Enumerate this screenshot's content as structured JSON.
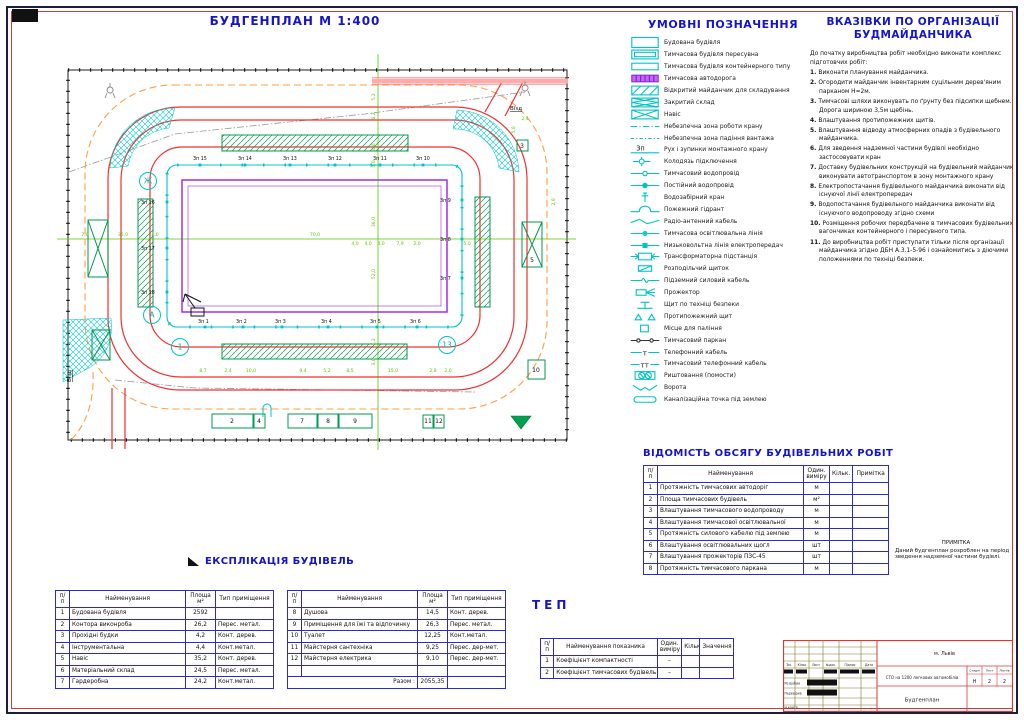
{
  "title": "БУДГЕНПЛАН М 1:400",
  "legend": {
    "title": "УМОВНІ ПОЗНАЧЕННЯ",
    "items": [
      {
        "symbol": "building-outline-icon",
        "label": "Будована будівля"
      },
      {
        "symbol": "mobile-building-icon",
        "label": "Тимчасова будівля пересувна"
      },
      {
        "symbol": "container-building-icon",
        "label": "Тимчасова будівля контейнерного типу"
      },
      {
        "symbol": "temp-road-icon",
        "label": "Тимчасова автодорога"
      },
      {
        "symbol": "open-storage-icon",
        "label": "Відкритий майданчик для складування"
      },
      {
        "symbol": "closed-storage-icon",
        "label": "Закритий склад"
      },
      {
        "symbol": "shed-icon",
        "label": "Навіс"
      },
      {
        "symbol": "danger-crane-zone-icon",
        "label": "Небезпечна зона роботи крану"
      },
      {
        "symbol": "danger-load-zone-icon",
        "label": "Небезпечна зона падіння вантажа"
      },
      {
        "symbol": "crane-stops-icon",
        "label": "Рух і зупинки монтажного крану"
      },
      {
        "symbol": "connection-well-icon",
        "label": "Колодязь підключення"
      },
      {
        "symbol": "temp-water-line-icon",
        "label": "Тимчасовий водопровід"
      },
      {
        "symbol": "perm-water-line-icon",
        "label": "Постійний водопровід"
      },
      {
        "symbol": "water-tap-icon",
        "label": "Водозабірний кран"
      },
      {
        "symbol": "fire-hydrant-icon",
        "label": "Пожежний гідрант"
      },
      {
        "symbol": "radio-cable-icon",
        "label": "Радіо-антенний кабель"
      },
      {
        "symbol": "temp-light-line-icon",
        "label": "Тимчасова освітлювальна лінія"
      },
      {
        "symbol": "lv-power-line-icon",
        "label": "Низьковольтна лінія електропередач"
      },
      {
        "symbol": "transformer-icon",
        "label": "Трансформаторна підстанція"
      },
      {
        "symbol": "switchboard-icon",
        "label": "Розподільчий щиток"
      },
      {
        "symbol": "underground-cable-icon",
        "label": "Підземний силовий кабель"
      },
      {
        "symbol": "floodlight-icon",
        "label": "Прожектор"
      },
      {
        "symbol": "safety-board-icon",
        "label": "Щит по техніці безпеки"
      },
      {
        "symbol": "fire-board-icon",
        "label": "Протипожежний щит"
      },
      {
        "symbol": "smoking-area-icon",
        "label": "Місце для паління"
      },
      {
        "symbol": "temp-fence-icon",
        "label": "Тимчасовий паркан"
      },
      {
        "symbol": "phone-cable-icon",
        "label": "Телефонний кабель"
      },
      {
        "symbol": "temp-phone-cable-icon",
        "label": "Тимчасовий телефонний кабель"
      },
      {
        "symbol": "scaffold-icon",
        "label": "Риштовання (помости)"
      },
      {
        "symbol": "gate-icon",
        "label": "Ворота"
      },
      {
        "symbol": "sewer-point-icon",
        "label": "Каналізаційна точка під землею"
      }
    ]
  },
  "instructions": {
    "title_line1": "ВКАЗІВКИ ПО ОРГАНІЗАЦІЇ",
    "title_line2": "БУДМАЙДАНЧИКА",
    "intro": "До початку виробництва робіт необхідно виконати комплекс підготовчих робіт:",
    "items": [
      "Виконати планування майданчика.",
      "Огородити майданчик інвентарним суцільним дерев'яним парканом Н=2м.",
      "Тимчасові шляхи виконувать по ґрунту без підсипки щебнем. Дорога шириною 3,5м щебінь.",
      "Влаштування протипожежних щитів.",
      "Влаштування відводу атмосферних опадів з будівельного майданчика.",
      "Для зведення надземної частини будівлі необхідно застосовувати кран",
      "Доставку будівельних конструкцій на будівельний майданчик виконувати автотранспортом в зону монтажного крану",
      "Електропостачання будівельного майданчика виконати від існуючої лінії електропередач",
      "Водопостачання будівельного майданчика виконати від існуючого водопроводу згідно схеми",
      "Розміщення робочих передбачене в тимчасових будівельних вагончиках контейнерного і пересувного типа.",
      "До виробництва робіт приступати тільки після організації майданчика згідно ДБН А.3.1-5-96 і ознайомитись з діючими положеннями по техніці безпеки."
    ]
  },
  "works_table": {
    "title": "ВІДОМІСТЬ ОБСЯГУ  БУДІВЕЛЬНИХ РОБІТ",
    "headers": [
      "п/п",
      "Найменування",
      "Один. виміру",
      "Кільк.",
      "Примітка"
    ],
    "rows": [
      [
        "1",
        "Протяжність тимчасових автодоріг",
        "м",
        "",
        ""
      ],
      [
        "2",
        "Площа тимчасових будівель",
        "м²",
        "",
        ""
      ],
      [
        "3",
        "Влаштування тимчасового водопроводу",
        "м",
        "",
        ""
      ],
      [
        "4",
        "Влаштування тимчасової освітлювальної",
        "м",
        "",
        ""
      ],
      [
        "5",
        "Протяжність силового кабелю під землею",
        "м",
        "",
        ""
      ],
      [
        "6",
        "Влаштування освітлювальних щогл",
        "шт",
        "",
        ""
      ],
      [
        "7",
        "Влаштування прожекторів ПЗС-45",
        "шт",
        "",
        ""
      ],
      [
        "8",
        "Протяжність тимчасового паркана",
        "м",
        "",
        ""
      ]
    ]
  },
  "note": {
    "title": "ПРИМІТКА",
    "text": "Даний будгенплан розроблен на період зведення надземної частини будівлі."
  },
  "explication": {
    "title": "ЕКСПЛІКАЦІЯ БУДІВЕЛЬ",
    "headers": [
      "п/п",
      "Найменування",
      "Площа м²",
      "Тип приміщення"
    ],
    "left_rows": [
      [
        "1",
        "Будована будівля",
        "2592",
        ""
      ],
      [
        "2",
        "Контора виконроба",
        "26,2",
        "Перес. метал."
      ],
      [
        "3",
        "Прохідні будки",
        "4,2",
        "Конт. дерев."
      ],
      [
        "4",
        "Інструментальна",
        "4,4",
        "Конт.метал."
      ],
      [
        "5",
        "Навіс",
        "35,2",
        "Конт. дерев."
      ],
      [
        "6",
        "Матеріальний склад",
        "24,5",
        "Перес. метал."
      ],
      [
        "7",
        "Гардеробна",
        "24,2",
        "Конт.метал."
      ]
    ],
    "right_rows": [
      [
        "8",
        "Душова",
        "14,5",
        "Конт. дерев."
      ],
      [
        "9",
        "Приміщення для їжі та відпочинку",
        "26,3",
        "Перес. метал."
      ],
      [
        "10",
        "Туалет",
        "12,25",
        "Конт.метал."
      ],
      [
        "11",
        "Майстерня сантехніка",
        "9,25",
        "Перес. дер-мет."
      ],
      [
        "12",
        "Майстерня електрика",
        "9,10",
        "Перес. дер-мет."
      ],
      [
        "",
        "",
        "",
        ""
      ]
    ],
    "total_label": "Разом :",
    "total_value": "2055,35"
  },
  "tep": {
    "title": "ТЕП",
    "headers": [
      "п/п",
      "Найменування показника",
      "Один. виміру",
      "Кільк",
      "Значення"
    ],
    "rows": [
      [
        "1",
        "Коефіцієнт компактності",
        "–",
        "",
        ""
      ],
      [
        "2",
        "Коефіцієнт тимчасових будівель",
        "–",
        "",
        ""
      ]
    ]
  },
  "stamp": {
    "city": "м. Львів",
    "project": "СТО на 1200 легкових автомобілів",
    "stage_label": "Стадія",
    "sheet_label": "Лист",
    "sheets_label": "Листів",
    "stage": "Н",
    "sheet": "2",
    "sheets": "2",
    "drawing_title": "Будгенплан",
    "cols": [
      "Зм.",
      "Кільк",
      "Лист",
      "№док.",
      "Підпис",
      "Дата"
    ],
    "roles": [
      "Розробив",
      "Перевірив",
      "Н.контр."
    ]
  },
  "plan": {
    "axes": [
      {
        "t": "Ж",
        "x": 93,
        "y": 129
      },
      {
        "t": "А",
        "x": 97,
        "y": 263
      },
      {
        "t": "1",
        "x": 125,
        "y": 295
      },
      {
        "t": "13",
        "x": 392,
        "y": 293
      }
    ],
    "crane_stops": [
      {
        "t": "Зп 1",
        "x": 143,
        "y": 271,
        "sx": 150,
        "sy": 275
      },
      {
        "t": "Зп 2",
        "x": 181,
        "y": 271,
        "sx": 188,
        "sy": 275
      },
      {
        "t": "Зп 3",
        "x": 220,
        "y": 271,
        "sx": 227,
        "sy": 275
      },
      {
        "t": "Зп 4",
        "x": 266,
        "y": 271,
        "sx": 273,
        "sy": 275
      },
      {
        "t": "Зп 5",
        "x": 315,
        "y": 271,
        "sx": 322,
        "sy": 275
      },
      {
        "t": "Зп 6",
        "x": 355,
        "y": 271,
        "sx": 362,
        "sy": 275
      },
      {
        "t": "Зп 7",
        "x": 385,
        "y": 228,
        "sx": 407,
        "sy": 226
      },
      {
        "t": "Зп 8",
        "x": 385,
        "y": 189,
        "sx": 407,
        "sy": 187
      },
      {
        "t": "Зп 9",
        "x": 385,
        "y": 150,
        "sx": 407,
        "sy": 148
      },
      {
        "t": "Зп 10",
        "x": 361,
        "y": 108,
        "sx": 368,
        "sy": 113
      },
      {
        "t": "Зп 11",
        "x": 318,
        "y": 108,
        "sx": 325,
        "sy": 113
      },
      {
        "t": "Зп 12",
        "x": 273,
        "y": 108,
        "sx": 280,
        "sy": 113
      },
      {
        "t": "Зп 13",
        "x": 228,
        "y": 108,
        "sx": 235,
        "sy": 113
      },
      {
        "t": "Зп 14",
        "x": 183,
        "y": 108,
        "sx": 190,
        "sy": 113
      },
      {
        "t": "Зп 15",
        "x": 138,
        "y": 108,
        "sx": 145,
        "sy": 113
      },
      {
        "t": "Зп 16",
        "x": 86,
        "y": 152,
        "sx": 112,
        "sy": 150
      },
      {
        "t": "Зп 17",
        "x": 86,
        "y": 198,
        "sx": 112,
        "sy": 196
      },
      {
        "t": "Зп 18",
        "x": 86,
        "y": 242,
        "sx": 112,
        "sy": 240
      }
    ],
    "building_numbers": [
      {
        "t": "2",
        "x": 177,
        "y": 371
      },
      {
        "t": "4",
        "x": 204,
        "y": 371
      },
      {
        "t": "7",
        "x": 247,
        "y": 371
      },
      {
        "t": "8",
        "x": 273,
        "y": 371
      },
      {
        "t": "9",
        "x": 300,
        "y": 371
      },
      {
        "t": "11",
        "x": 373,
        "y": 371
      },
      {
        "t": "12",
        "x": 384,
        "y": 371
      },
      {
        "t": "3",
        "x": 467,
        "y": 96
      },
      {
        "t": "5",
        "x": 477,
        "y": 210
      },
      {
        "t": "10",
        "x": 481,
        "y": 320
      }
    ],
    "dimensions": [
      {
        "t": "8,7",
        "x": 148,
        "y": 320
      },
      {
        "t": "2,4",
        "x": 173,
        "y": 320
      },
      {
        "t": "10,0",
        "x": 196,
        "y": 320
      },
      {
        "t": "9,4",
        "x": 248,
        "y": 320
      },
      {
        "t": "5,2",
        "x": 272,
        "y": 320
      },
      {
        "t": "8,5",
        "x": 295,
        "y": 320
      },
      {
        "t": "15,0",
        "x": 338,
        "y": 320
      },
      {
        "t": "2,8",
        "x": 378,
        "y": 320
      },
      {
        "t": "2,0",
        "x": 393,
        "y": 320
      },
      {
        "t": "7,0",
        "x": 30,
        "y": 184
      },
      {
        "t": "35,0",
        "x": 68,
        "y": 184
      },
      {
        "t": "4,0",
        "x": 100,
        "y": 184
      },
      {
        "t": "70,0",
        "x": 260,
        "y": 184
      },
      {
        "t": "4,0",
        "x": 300,
        "y": 193
      },
      {
        "t": "4,0",
        "x": 313,
        "y": 193
      },
      {
        "t": "4,0",
        "x": 326,
        "y": 193
      },
      {
        "t": "7,9",
        "x": 345,
        "y": 193
      },
      {
        "t": "2,0",
        "x": 362,
        "y": 193
      },
      {
        "t": "5,0",
        "x": 412,
        "y": 193
      },
      {
        "t": "5,2",
        "x": 320,
        "y": 45,
        "r": -90
      },
      {
        "t": "6,2",
        "x": 320,
        "y": 64,
        "r": -90
      },
      {
        "t": "4,6",
        "x": 320,
        "y": 95,
        "r": -90
      },
      {
        "t": "4,0",
        "x": 320,
        "y": 112,
        "r": -90
      },
      {
        "t": "36,0",
        "x": 320,
        "y": 170,
        "r": -90
      },
      {
        "t": "52,0",
        "x": 320,
        "y": 222,
        "r": -90
      },
      {
        "t": "7,2",
        "x": 320,
        "y": 290,
        "r": -90
      },
      {
        "t": "3,0",
        "x": 320,
        "y": 310,
        "r": -90
      },
      {
        "t": "5,0",
        "x": 460,
        "y": 78,
        "r": -90
      },
      {
        "t": "2,4",
        "x": 470,
        "y": 68
      },
      {
        "t": "2,0",
        "x": 500,
        "y": 150,
        "r": -90
      }
    ],
    "misc_labels": [
      {
        "t": "Вїзд",
        "x": 455,
        "y": 58,
        "u": true
      },
      {
        "t": "Вїзд",
        "x": 16,
        "y": 330,
        "r": -90,
        "u": true
      }
    ]
  }
}
